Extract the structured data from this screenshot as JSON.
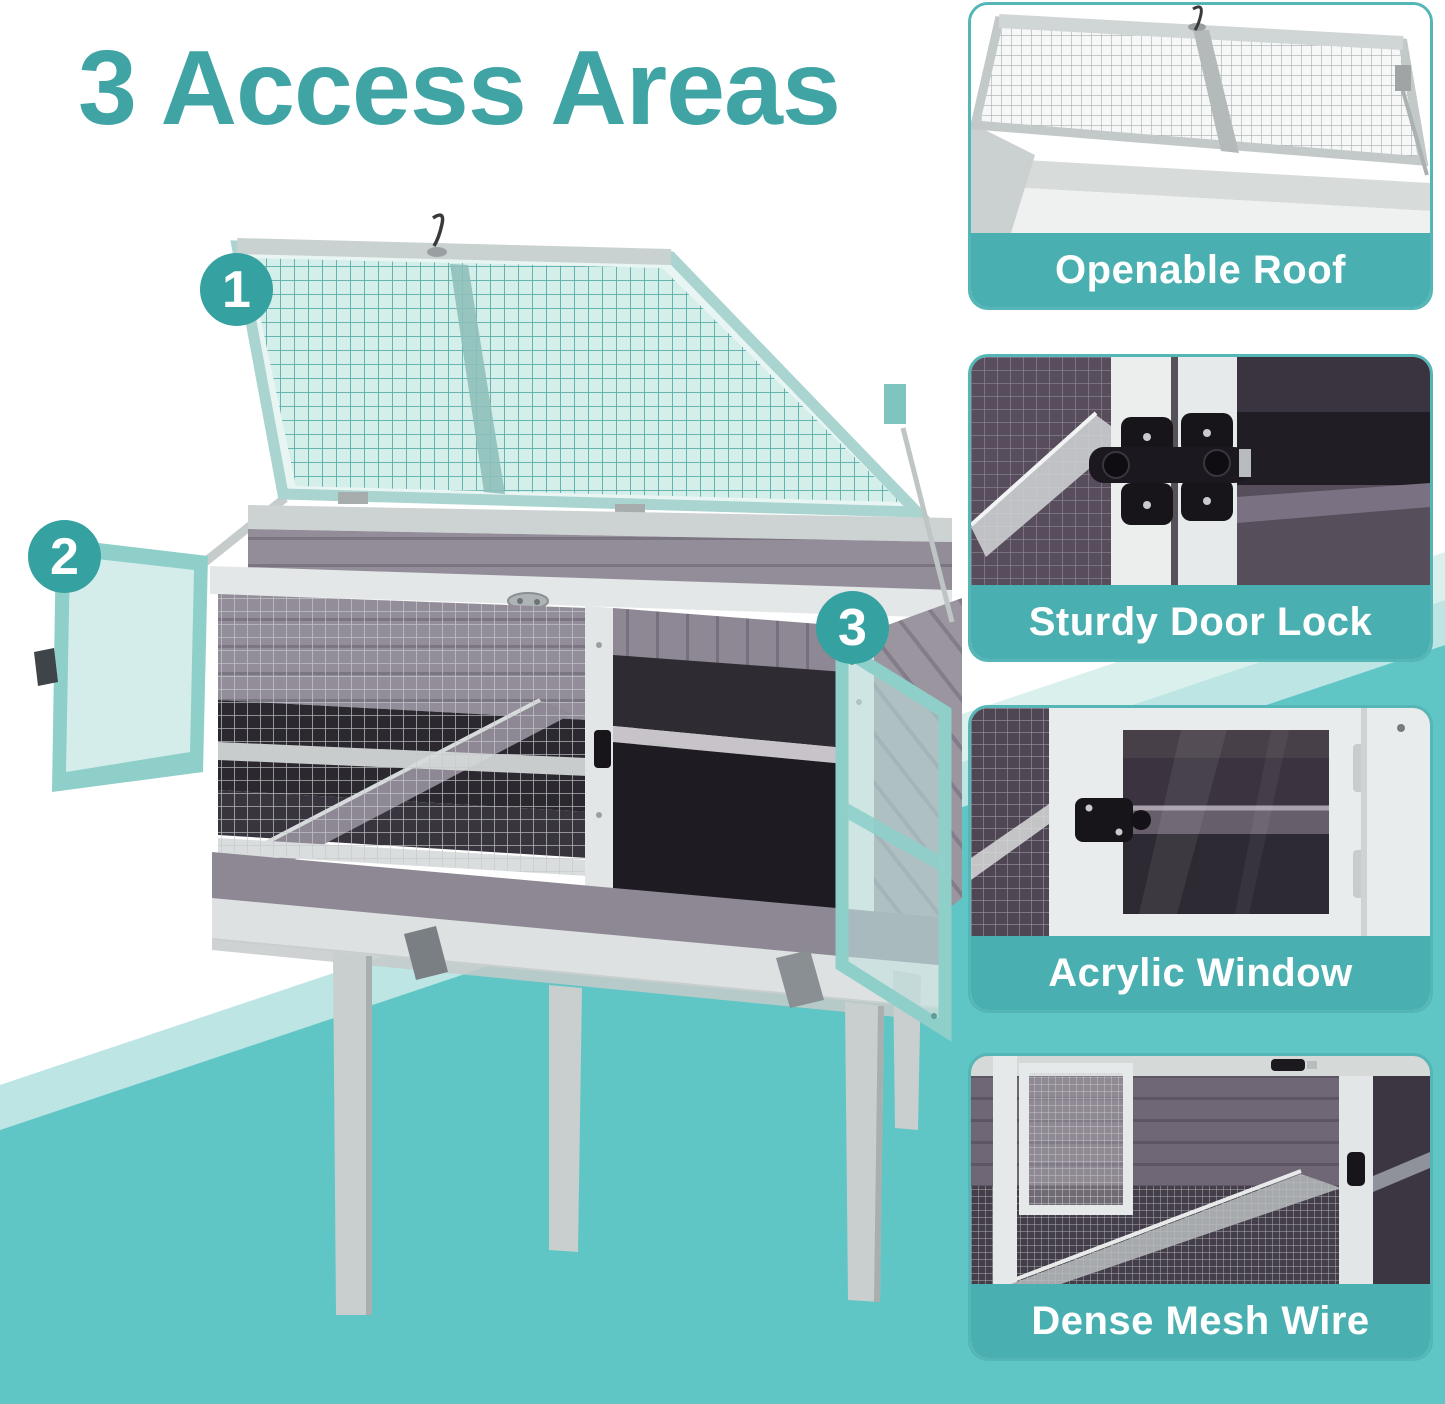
{
  "title": "3 Access Areas",
  "markers": [
    {
      "value": "1"
    },
    {
      "value": "2"
    },
    {
      "value": "3"
    }
  ],
  "features": [
    {
      "label": "Openable Roof",
      "icon": "roof-mesh-lid"
    },
    {
      "label": "Sturdy Door Lock",
      "icon": "door-lock-latch"
    },
    {
      "label": "Acrylic Window",
      "icon": "acrylic-window-door"
    },
    {
      "label": "Dense Mesh Wire",
      "icon": "mesh-wire-floor"
    }
  ],
  "colors": {
    "title_teal": "#40A4A4",
    "marker_teal": "#35A2A1",
    "card_border_teal": "#54B6B6",
    "label_band_teal": "#4AAFB0",
    "stripe_light": "#BCE5E3",
    "stripe_pale": "#D9F0ED",
    "stripe_dark": "#5FC6C5",
    "lid_mesh_teal": "#CDEBE7",
    "door_acrylic": "#D8EEEB"
  }
}
